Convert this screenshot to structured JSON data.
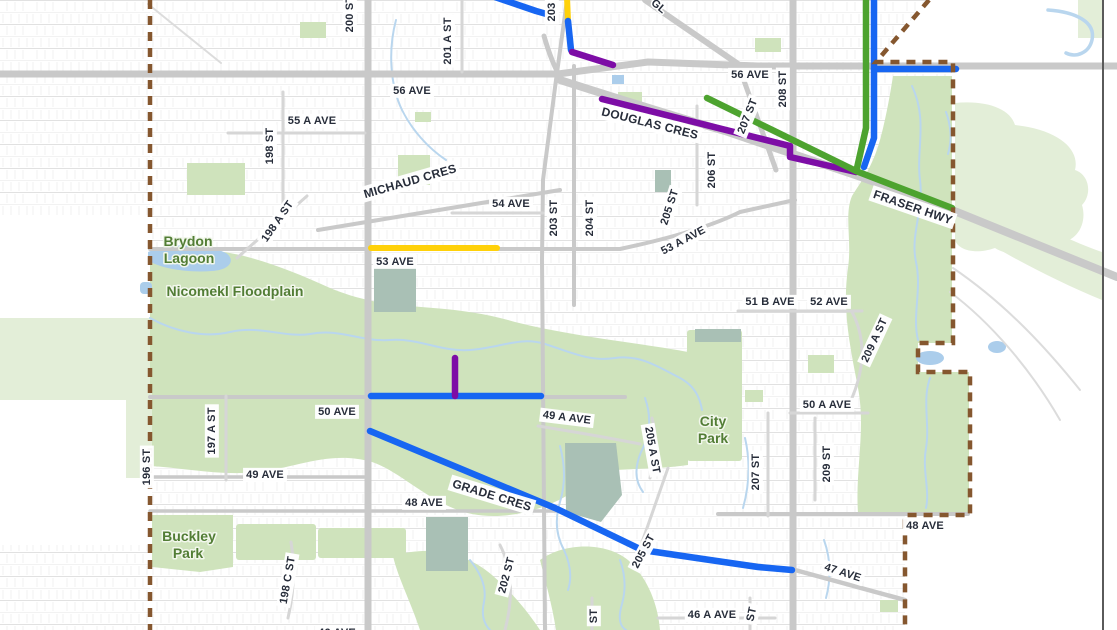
{
  "map": {
    "description": "City street map with dashed municipal boundary and coloured cycling-route overlay",
    "place_labels": [
      {
        "text": "Brydon",
        "x": 188,
        "y": 241
      },
      {
        "text": "Lagoon",
        "x": 189,
        "y": 258
      },
      {
        "text": "Nicomekl Floodplain",
        "x": 235,
        "y": 291
      },
      {
        "text": "City",
        "x": 713,
        "y": 421
      },
      {
        "text": "Park",
        "x": 713,
        "y": 438
      },
      {
        "text": "Buckley",
        "x": 189,
        "y": 536
      },
      {
        "text": "Park",
        "x": 188,
        "y": 553
      }
    ],
    "street_labels": [
      {
        "text": "200 ST",
        "x": 349,
        "y": 14,
        "rot": -90
      },
      {
        "text": "201 A ST",
        "x": 447,
        "y": 41,
        "rot": -90
      },
      {
        "text": "203",
        "x": 551,
        "y": 12,
        "rot": -90
      },
      {
        "text": "GL",
        "x": 659,
        "y": 6,
        "rot": 40,
        "box": false
      },
      {
        "text": "56 AVE",
        "x": 412,
        "y": 90,
        "rot": 0
      },
      {
        "text": "55 A AVE",
        "x": 312,
        "y": 120,
        "rot": 0
      },
      {
        "text": "198 ST",
        "x": 269,
        "y": 146,
        "rot": -90
      },
      {
        "text": "MICHAUD CRES",
        "x": 410,
        "y": 181,
        "rot": -16,
        "size": 12
      },
      {
        "text": "54 AVE",
        "x": 511,
        "y": 203,
        "rot": 0
      },
      {
        "text": "198 A ST",
        "x": 277,
        "y": 221,
        "rot": -55
      },
      {
        "text": "203 ST",
        "x": 553,
        "y": 218,
        "rot": -90
      },
      {
        "text": "204 ST",
        "x": 589,
        "y": 218,
        "rot": -90
      },
      {
        "text": "53 AVE",
        "x": 395,
        "y": 261,
        "rot": 0
      },
      {
        "text": "205 ST",
        "x": 669,
        "y": 207,
        "rot": -72
      },
      {
        "text": "53 A AVE",
        "x": 683,
        "y": 240,
        "rot": -28
      },
      {
        "text": "206 ST",
        "x": 711,
        "y": 170,
        "rot": -90
      },
      {
        "text": "207 ST",
        "x": 747,
        "y": 116,
        "rot": -68
      },
      {
        "text": "208 ST",
        "x": 782,
        "y": 89,
        "rot": -90
      },
      {
        "text": "56 AVE",
        "x": 750,
        "y": 74,
        "rot": 0
      },
      {
        "text": "DOUGLAS CRES",
        "x": 650,
        "y": 123,
        "rot": 14,
        "size": 12
      },
      {
        "text": "FRASER HWY",
        "x": 913,
        "y": 207,
        "rot": 19,
        "size": 12
      },
      {
        "text": "51 B AVE",
        "x": 770,
        "y": 301,
        "rot": 0
      },
      {
        "text": "52 AVE",
        "x": 829,
        "y": 301,
        "rot": 0
      },
      {
        "text": "209 A ST",
        "x": 874,
        "y": 340,
        "rot": -65
      },
      {
        "text": "50 A AVE",
        "x": 827,
        "y": 404,
        "rot": 0
      },
      {
        "text": "50 AVE",
        "x": 337,
        "y": 411,
        "rot": 0
      },
      {
        "text": "49 A AVE",
        "x": 567,
        "y": 417,
        "rot": 7
      },
      {
        "text": "197 A ST",
        "x": 211,
        "y": 431,
        "rot": -90
      },
      {
        "text": "196 ST",
        "x": 146,
        "y": 467,
        "rot": -90
      },
      {
        "text": "49 AVE",
        "x": 265,
        "y": 474,
        "rot": 0
      },
      {
        "text": "48 AVE",
        "x": 424,
        "y": 502,
        "rot": 0
      },
      {
        "text": "GRADE CRES",
        "x": 492,
        "y": 495,
        "rot": 17,
        "size": 12
      },
      {
        "text": "205 A ST",
        "x": 653,
        "y": 450,
        "rot": 80
      },
      {
        "text": "207 ST",
        "x": 755,
        "y": 472,
        "rot": -90
      },
      {
        "text": "209 ST",
        "x": 826,
        "y": 464,
        "rot": -90
      },
      {
        "text": "48 AVE",
        "x": 925,
        "y": 525,
        "rot": 0
      },
      {
        "text": "202 ST",
        "x": 506,
        "y": 575,
        "rot": -75
      },
      {
        "text": "205 ST",
        "x": 643,
        "y": 551,
        "rot": -62
      },
      {
        "text": "198 C ST",
        "x": 287,
        "y": 580,
        "rot": -80
      },
      {
        "text": "47 AVE",
        "x": 843,
        "y": 572,
        "rot": 18
      },
      {
        "text": "46 A AVE",
        "x": 712,
        "y": 614,
        "rot": 0
      },
      {
        "text": "ST",
        "x": 593,
        "y": 616,
        "rot": -90
      },
      {
        "text": "ST",
        "x": 751,
        "y": 614,
        "rot": -78
      },
      {
        "text": "46 AVE",
        "x": 337,
        "y": 632,
        "rot": 0
      }
    ],
    "route_segments": [
      {
        "name": "top-diagonal-route-blue",
        "color": "route_blue",
        "width": 6.5,
        "points": [
          [
            495,
            -3
          ],
          [
            536,
            11
          ],
          [
            550,
            15
          ]
        ]
      },
      {
        "name": "203-st-route-yellow",
        "color": "route_yellow",
        "width": 6,
        "points": [
          [
            567,
            -3
          ],
          [
            568,
            21
          ]
        ]
      },
      {
        "name": "203-st-route-blue",
        "color": "route_blue",
        "width": 6.5,
        "points": [
          [
            568,
            21
          ],
          [
            571,
            50
          ]
        ]
      },
      {
        "name": "203-douglas-connector-purple",
        "color": "route_purple",
        "width": 6.5,
        "points": [
          [
            572,
            52
          ],
          [
            613,
            65
          ]
        ]
      },
      {
        "name": "douglas-cres-route-purple",
        "color": "route_purple",
        "width": 6.5,
        "points": [
          [
            602,
            99
          ],
          [
            790,
            146
          ],
          [
            790,
            157
          ],
          [
            856,
            172
          ]
        ]
      },
      {
        "name": "glover-fraser-route-green",
        "color": "route_green",
        "width": 6.5,
        "points": [
          [
            707,
            98
          ],
          [
            856,
            171
          ]
        ]
      },
      {
        "name": "fraser-hwy-route-green",
        "color": "route_green",
        "width": 6.5,
        "points": [
          [
            856,
            171
          ],
          [
            952,
            208
          ]
        ]
      },
      {
        "name": "north-vertical-route-green",
        "color": "route_green",
        "width": 6.5,
        "points": [
          [
            866,
            -4
          ],
          [
            866,
            128
          ],
          [
            857,
            168
          ]
        ]
      },
      {
        "name": "north-vertical-route-blue",
        "color": "route_blue",
        "width": 6.5,
        "points": [
          [
            874,
            -4
          ],
          [
            874,
            138
          ],
          [
            864,
            167
          ]
        ]
      },
      {
        "name": "56-ave-route-blue",
        "color": "route_blue",
        "width": 6.5,
        "points": [
          [
            874,
            69
          ],
          [
            956,
            69
          ]
        ]
      },
      {
        "name": "53-ave-route-yellow",
        "color": "route_yellow",
        "width": 6,
        "points": [
          [
            371,
            248
          ],
          [
            497,
            248
          ]
        ]
      },
      {
        "name": "50-ave-route-blue",
        "color": "route_blue",
        "width": 6.5,
        "points": [
          [
            371,
            396
          ],
          [
            541,
            396
          ]
        ]
      },
      {
        "name": "50-ave-spur-route-purple",
        "color": "route_purple",
        "width": 6.5,
        "points": [
          [
            455,
            358
          ],
          [
            455,
            396
          ]
        ]
      },
      {
        "name": "grade-cres-route-blue",
        "color": "route_blue",
        "width": 6.5,
        "points": [
          [
            370,
            431
          ],
          [
            555,
            508
          ],
          [
            642,
            550
          ],
          [
            710,
            560
          ],
          [
            758,
            567
          ],
          [
            792,
            570
          ]
        ]
      }
    ]
  },
  "colors": {
    "route_blue": "#1766f2",
    "route_green": "#4da32f",
    "route_purple": "#7d0da6",
    "route_yellow": "#ffd10a",
    "boundary_brown": "#85572f",
    "road_gray": "#c9c9c9",
    "green_fill": "#cfe3bc",
    "green_pale": "#e3eed8",
    "pond_teal": "#a9c0b5",
    "water_blue": "#b9d6ee",
    "lagoon_blue": "#abcdeb",
    "street_label": "#272d3a",
    "place_label": "#527d35",
    "frame_line": "#5a5a5a"
  }
}
